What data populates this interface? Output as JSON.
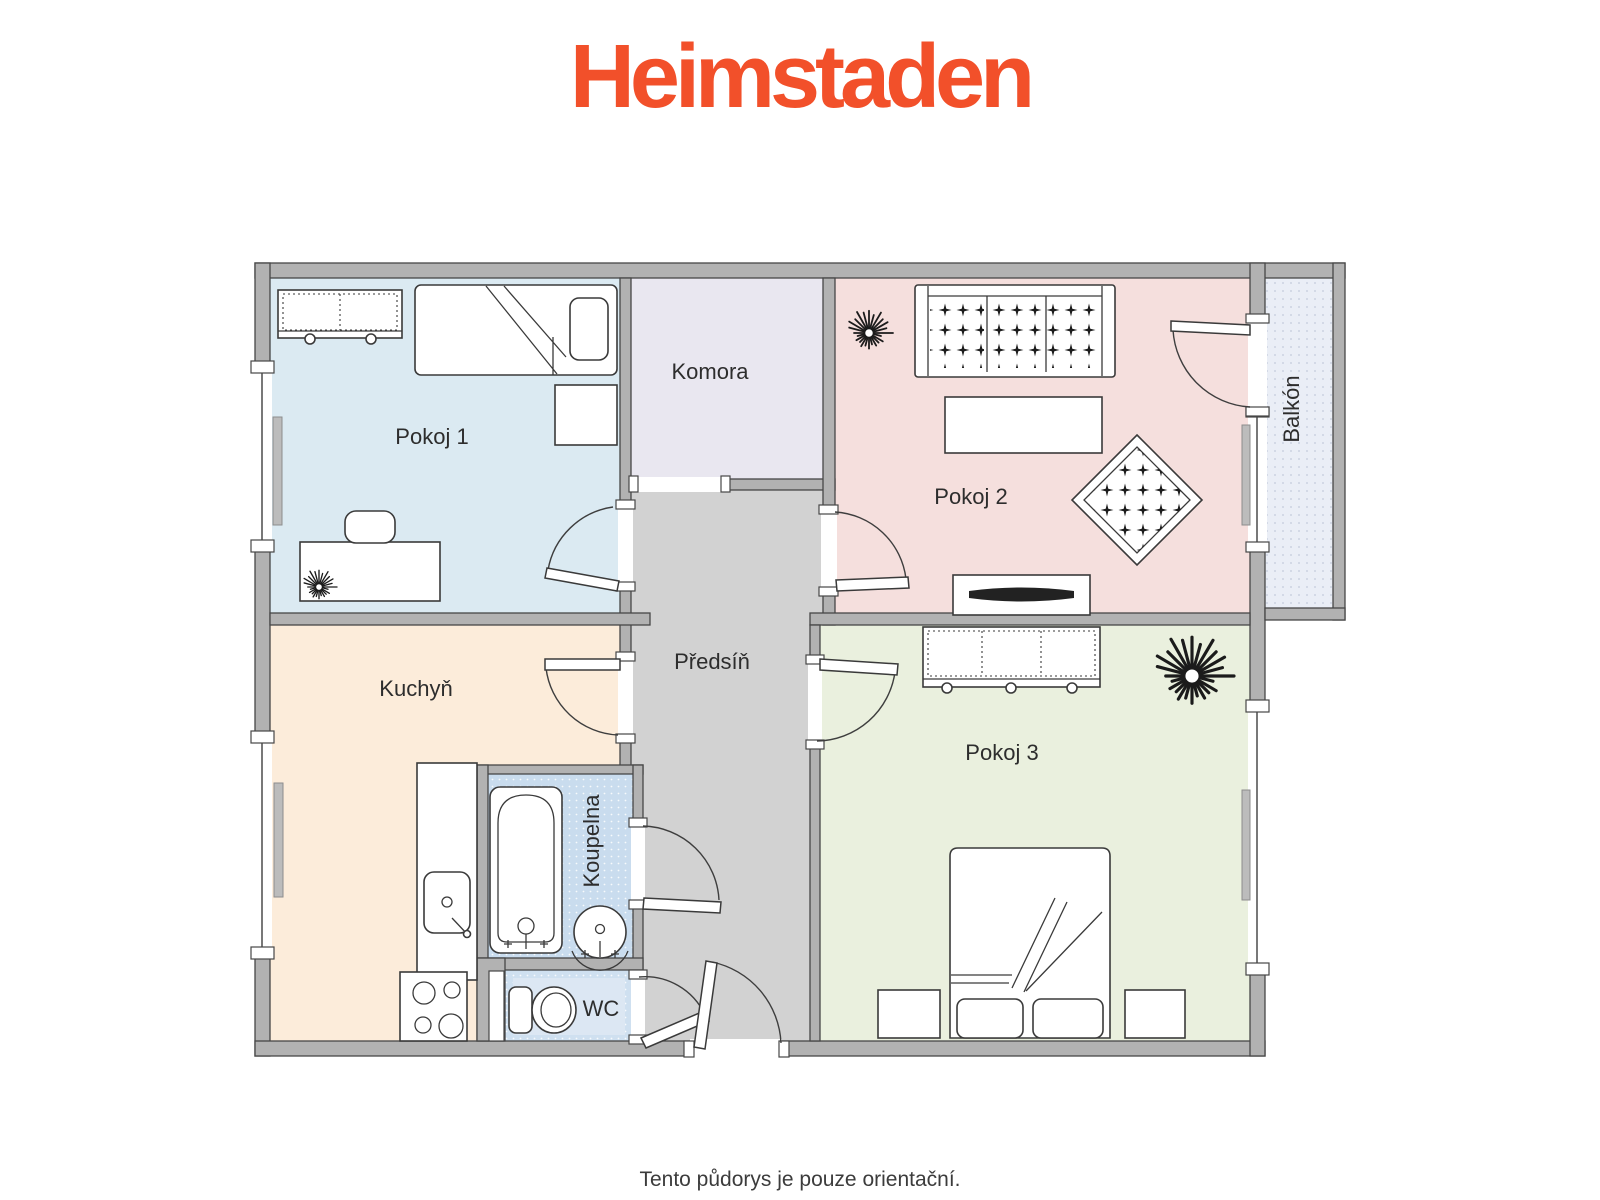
{
  "logo": {
    "text": "Heimstaden",
    "color": "#f2502a"
  },
  "plan": {
    "wall_color": "#b2b2b2",
    "outline_color": "#474747",
    "rooms": [
      {
        "id": "pokoj1",
        "label": "Pokoj 1",
        "color": "#dbeaf2"
      },
      {
        "id": "komora",
        "label": "Komora",
        "color": "#e9e7f0"
      },
      {
        "id": "pokoj2",
        "label": "Pokoj 2",
        "color": "#f5dfdd"
      },
      {
        "id": "balkon",
        "label": "Balkón",
        "color": "#eaeef6"
      },
      {
        "id": "kuchyn",
        "label": "Kuchyň",
        "color": "#fcecda"
      },
      {
        "id": "predsin",
        "label": "Předsíň",
        "color": "#d2d2d2"
      },
      {
        "id": "koupelna",
        "label": "Koupelna",
        "color": "#c9dcee"
      },
      {
        "id": "wc",
        "label": "WC",
        "color": "#cfe0f0"
      },
      {
        "id": "pokoj3",
        "label": "Pokoj 3",
        "color": "#eaf0de"
      }
    ]
  },
  "footer": {
    "note": "Tento půdorys je pouze orientační."
  }
}
